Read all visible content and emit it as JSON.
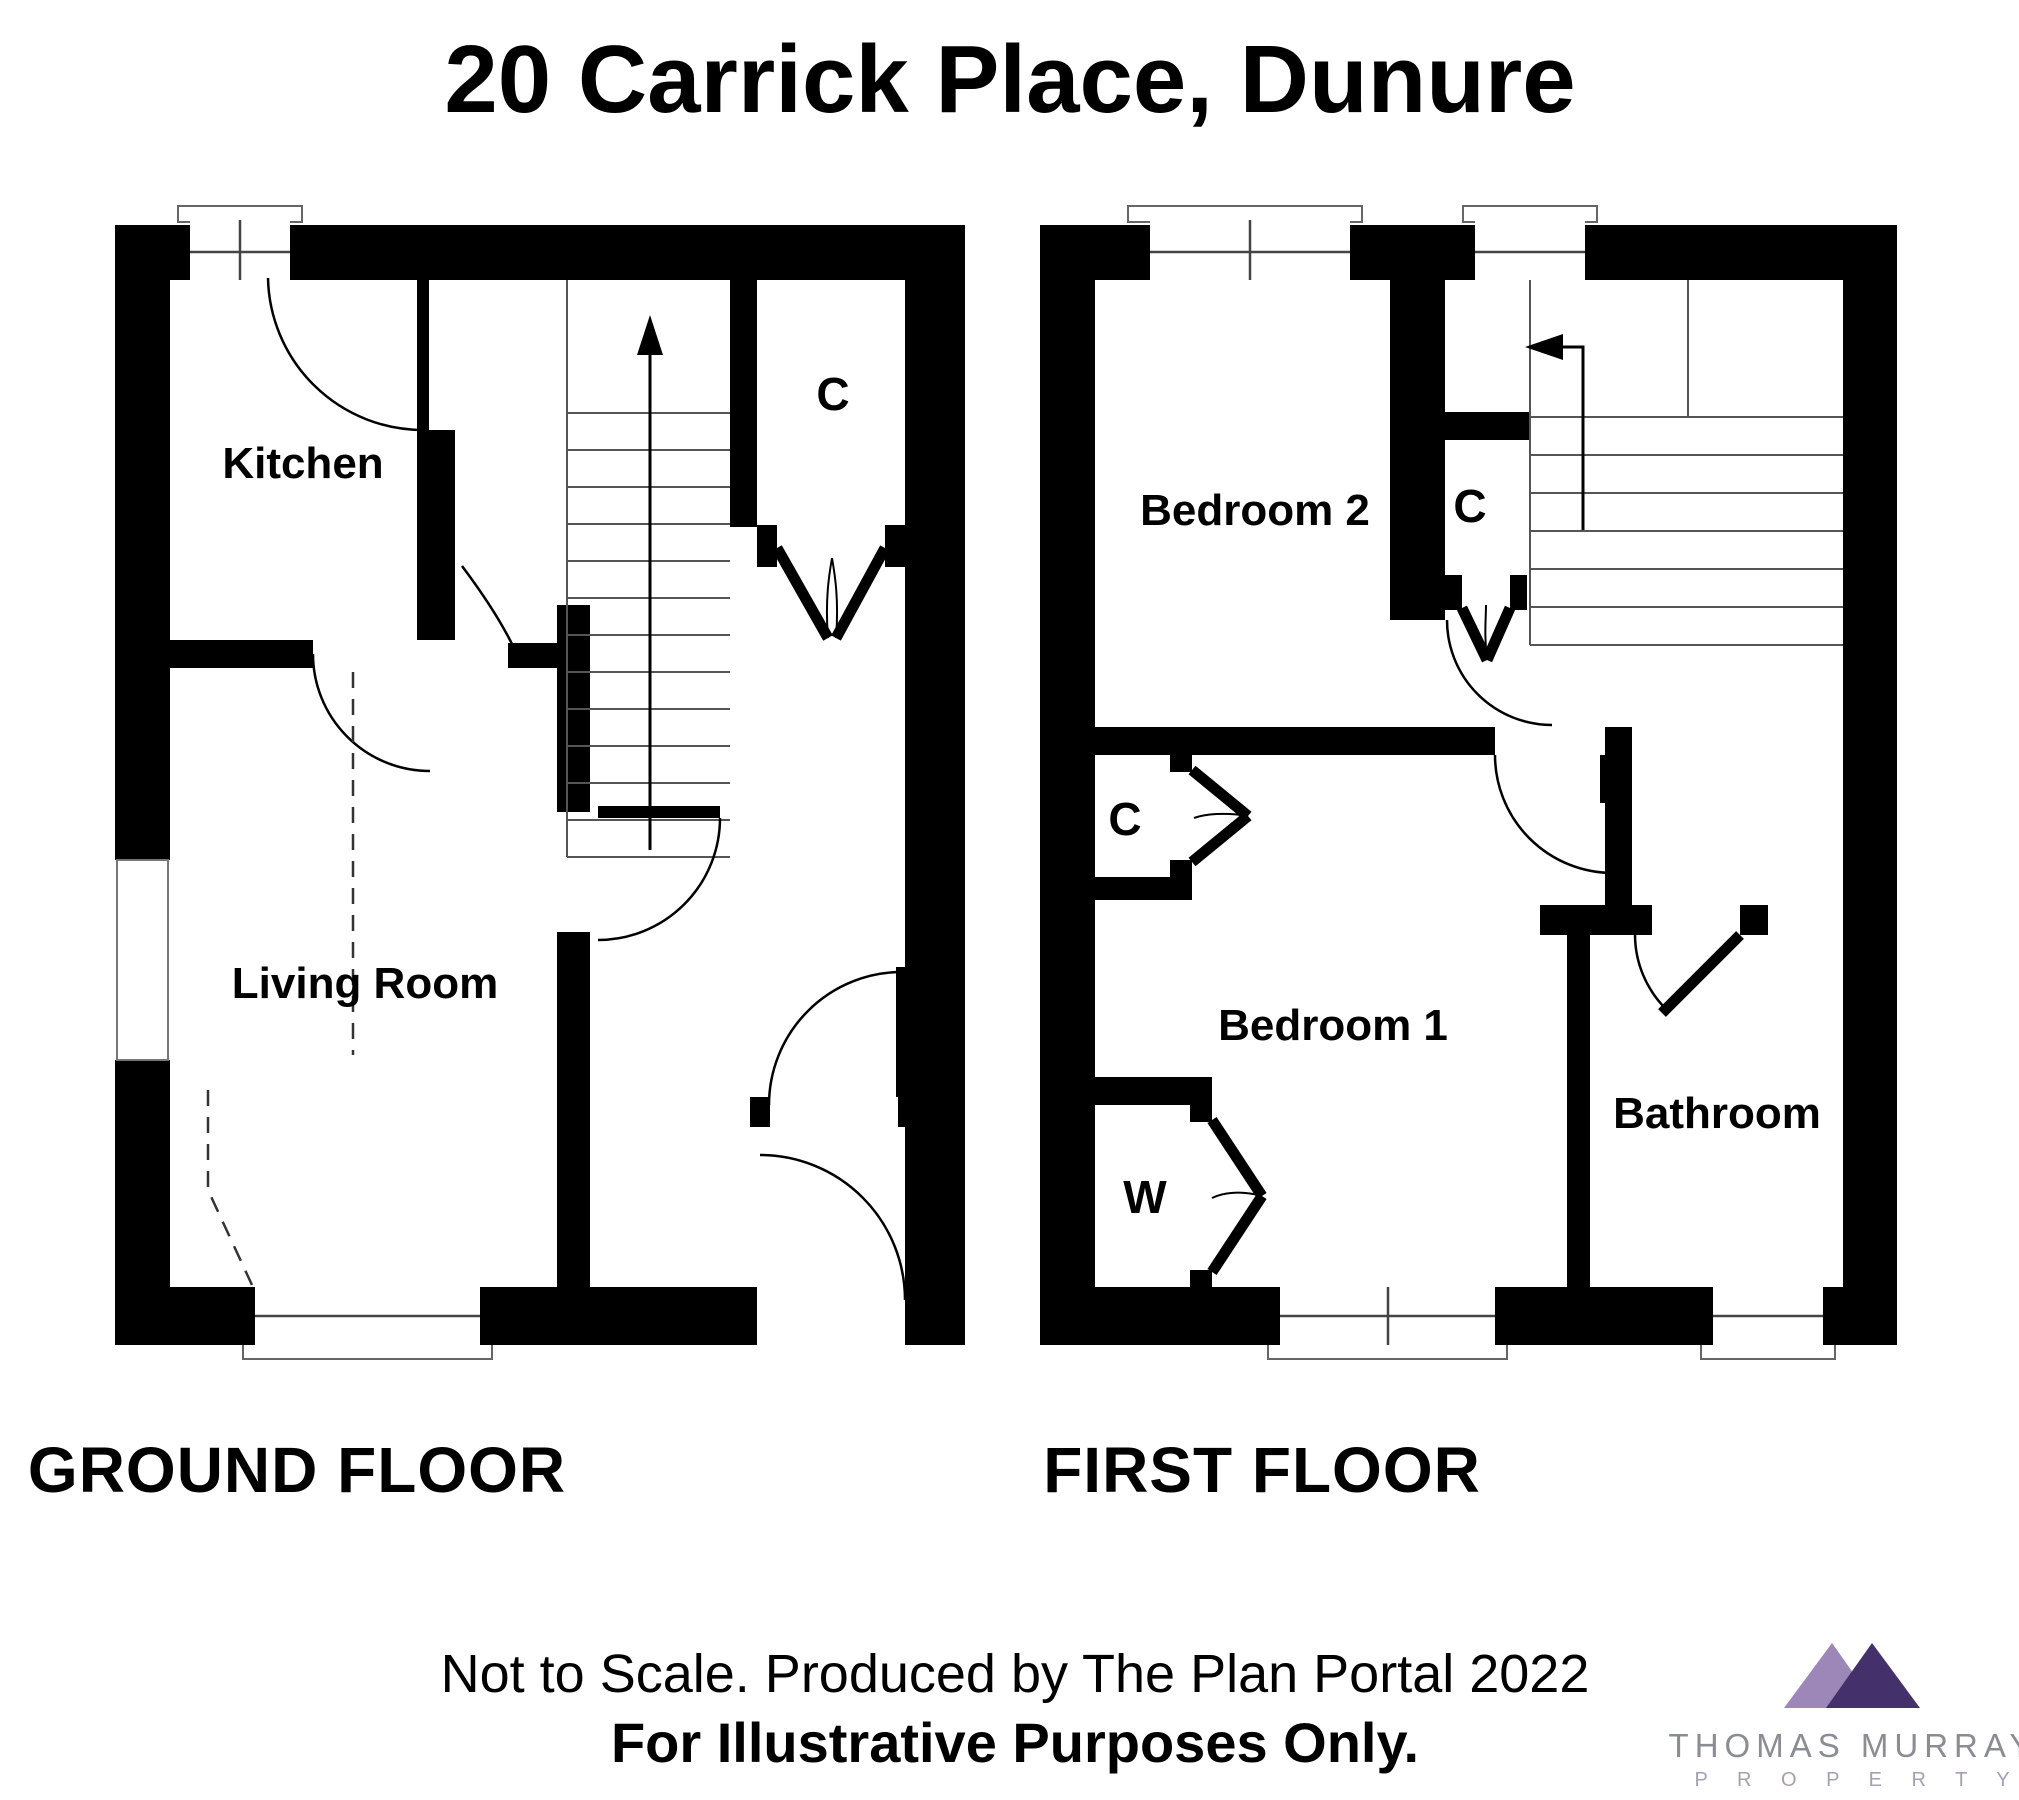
{
  "title": "20 Carrick Place, Dunure",
  "ground_floor": {
    "label": "GROUND FLOOR",
    "rooms": {
      "kitchen": "Kitchen",
      "living_room": "Living Room",
      "closet": "C"
    }
  },
  "first_floor": {
    "label": "FIRST FLOOR",
    "rooms": {
      "bedroom2": "Bedroom 2",
      "bedroom1": "Bedroom 1",
      "bathroom": "Bathroom",
      "closet_landing": "C",
      "closet_bedroom1": "C",
      "wardrobe": "W"
    }
  },
  "footer": {
    "line1": "Not to Scale. Produced by The Plan Portal 2022",
    "line2": "For Illustrative Purposes Only."
  },
  "logo": {
    "name": "THOMAS MURRAY",
    "subtitle": "P R O P E R T Y",
    "colors": {
      "left_triangle": "#9C87B8",
      "right_triangle": "#44306B",
      "name_color": "#8A8D94",
      "subtitle_color": "#A79FB2"
    }
  }
}
